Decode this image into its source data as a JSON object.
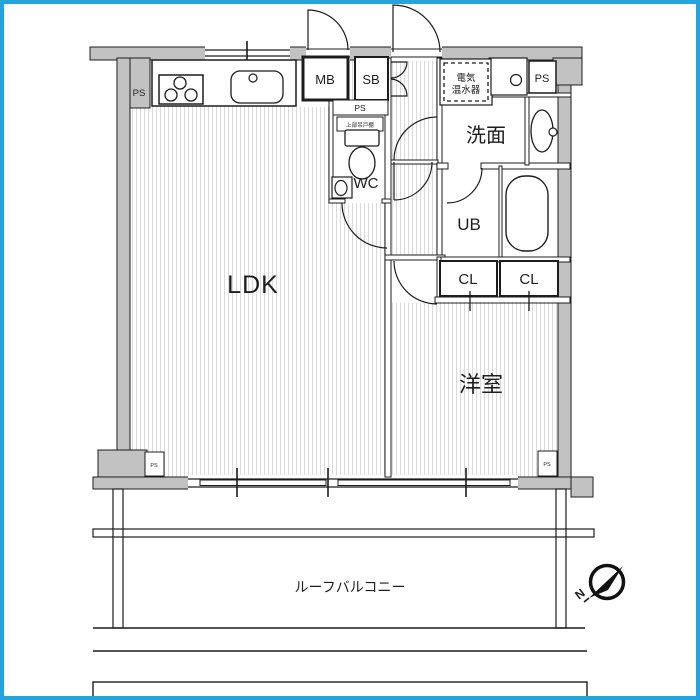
{
  "floor_plan": {
    "colors": {
      "wall_fill": "#c2c2c2",
      "line": "#1c1c1c",
      "floor_stripe": "#dadada",
      "frame_border": "#25a3dc",
      "background": "#ffffff"
    },
    "rooms": {
      "ldk": "LDK",
      "western_room": "洋室",
      "washroom": "洗面",
      "unit_bath": "UB",
      "wc": "WC",
      "closet_a": "CL",
      "closet_b": "CL",
      "meter_box": "MB",
      "shoe_box": "SB",
      "roof_balcony": "ルーフバルコニー"
    },
    "labels": {
      "ps_kitchen": "PS",
      "ps_wc_top": "PS",
      "ps_right_top": "PS",
      "ps_bottom_left": "PS",
      "ps_bottom_right": "PS",
      "water_heater_line1": "電気",
      "water_heater_line2": "温水器",
      "upper_cupboard": "上部吊戸棚",
      "compass_north": "N"
    },
    "fixture_icons": [
      "gas-stove-icon",
      "kitchen-sink-icon",
      "toilet-icon",
      "hand-basin-icon",
      "wash-oval-icon",
      "bathtub-icon",
      "washer-pan-icon",
      "water-heater-icon"
    ]
  }
}
